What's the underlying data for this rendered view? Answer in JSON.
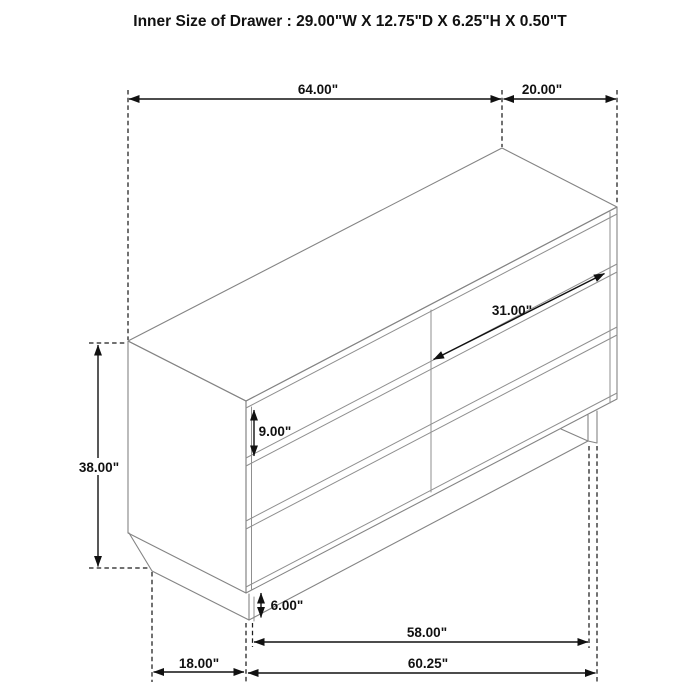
{
  "title": "Inner Size of Drawer : 29.00\"W X 12.75\"D X 6.25\"H X 0.50\"T",
  "diagram": {
    "type": "furniture-dimension-diagram",
    "subject": "six-drawer dresser, isometric line drawing",
    "labels": {
      "overall_width": "64.00\"",
      "overall_depth": "20.00\"",
      "drawer_front_width": "31.00\"",
      "drawer_front_height": "9.00\"",
      "overall_height": "38.00\"",
      "base_height": "6.00\"",
      "bottom_inner_width": "58.00\"",
      "bottom_outer_width": "60.25\"",
      "bottom_depth": "18.00\""
    }
  }
}
